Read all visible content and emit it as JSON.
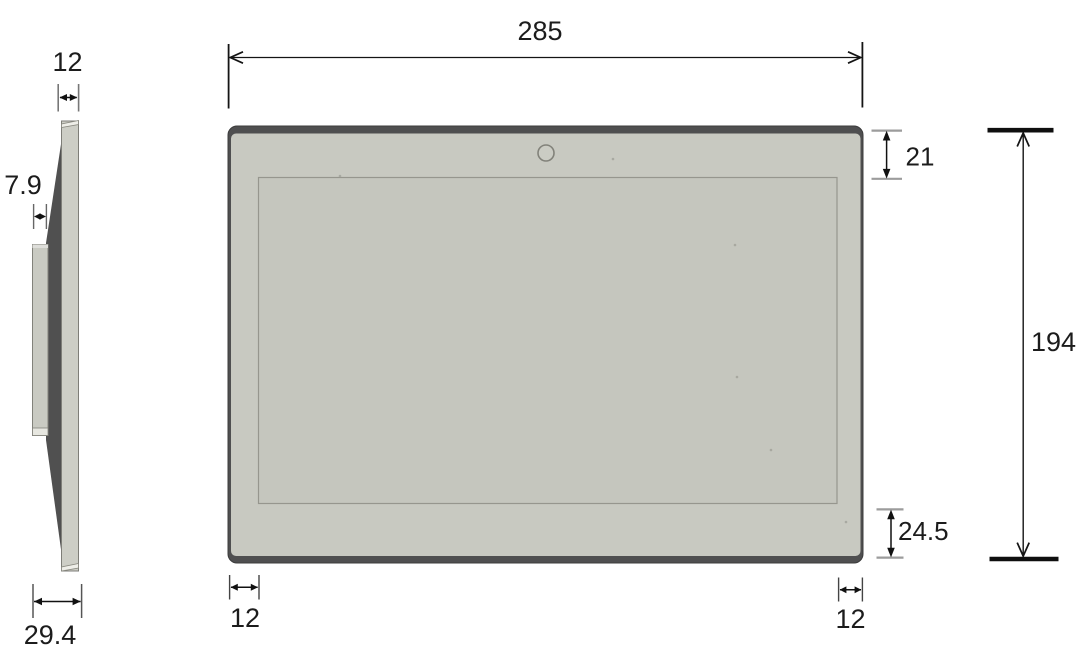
{
  "drawing": {
    "kind": "technical-dimension-drawing",
    "subject": "panel-display-front-and-side-views",
    "dimensions": {
      "front_width": "285",
      "overall_height": "194",
      "top_bezel": "21",
      "bottom_bezel": "24.5",
      "bottom_left_margin": "12",
      "bottom_right_margin": "12",
      "side_thickness": "12",
      "rear_protrusion_depth": "7.9",
      "overall_depth": "29.4"
    },
    "icons": {
      "camera_hole": "circle-outline"
    },
    "colors": {
      "background": "#ffffff",
      "bezel": "#c8c9c1",
      "screen": "#c5c6be",
      "dark_edge": "#4f4f50",
      "side_wedge": "#505050",
      "dim_line": "#1c1c1c",
      "tick_gray": "#9c9c9c"
    }
  }
}
